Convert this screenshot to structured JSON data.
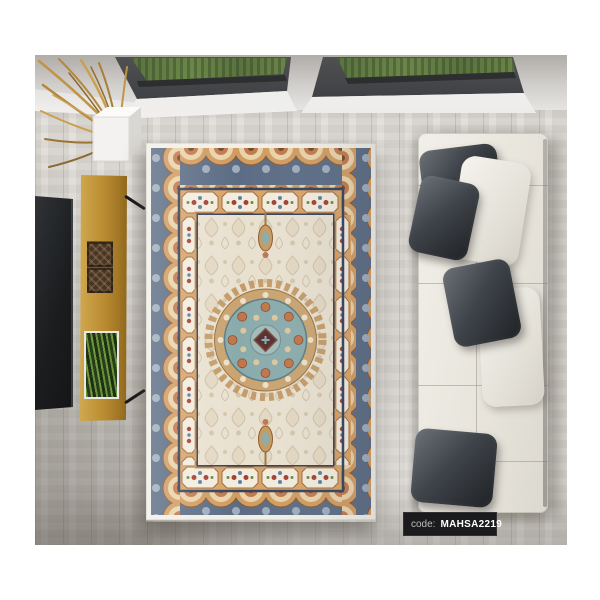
{
  "product_label": {
    "prefix": "code:",
    "code": "MAHSA2219"
  },
  "palette": {
    "label_bg": "#1b1b1d",
    "label_prefix_color": "#bdbdbd",
    "label_code_color": "#ffffff",
    "floor_wood": "#dfdcd7",
    "ceiling": "#e2e0de",
    "skylight_frame": "#3c3f43",
    "skylight_foliage": "#66854a",
    "tv_screen": "#1b1d1f",
    "bench_wood": "#b8892f",
    "decor_box": "#463526",
    "plant_green": "#5a8a34",
    "dried_branches": "#c19445",
    "branch_pot": "#f3f2f0",
    "rug_edge_white": "#f2efe8",
    "rug_border_blue": "#54657d",
    "rug_border_navy": "#33425c",
    "rug_arch_tan": "#d19c61",
    "rug_guard_tan": "#d8a368",
    "rug_panel_cream": "#f2ecdd",
    "rug_field": "#e9e1d0",
    "rug_damask": "#cfc0a8",
    "medallion_teal": "#8aabac",
    "medallion_rust": "#c0764a",
    "medallion_center": "#56302e",
    "sofa_leather": "#e9e6dd",
    "pillow_dark": "#3f444a",
    "pillow_light": "#efede6"
  },
  "scene_objects": [
    "skylight-left",
    "skylight-right",
    "dried-branches",
    "branch-pot",
    "wall-tv",
    "media-bench",
    "decor-box-1",
    "decor-box-2",
    "wall-planter",
    "persian-rug",
    "medallion",
    "sofa",
    "dark-pillows",
    "white-pillow",
    "product-code-label"
  ]
}
